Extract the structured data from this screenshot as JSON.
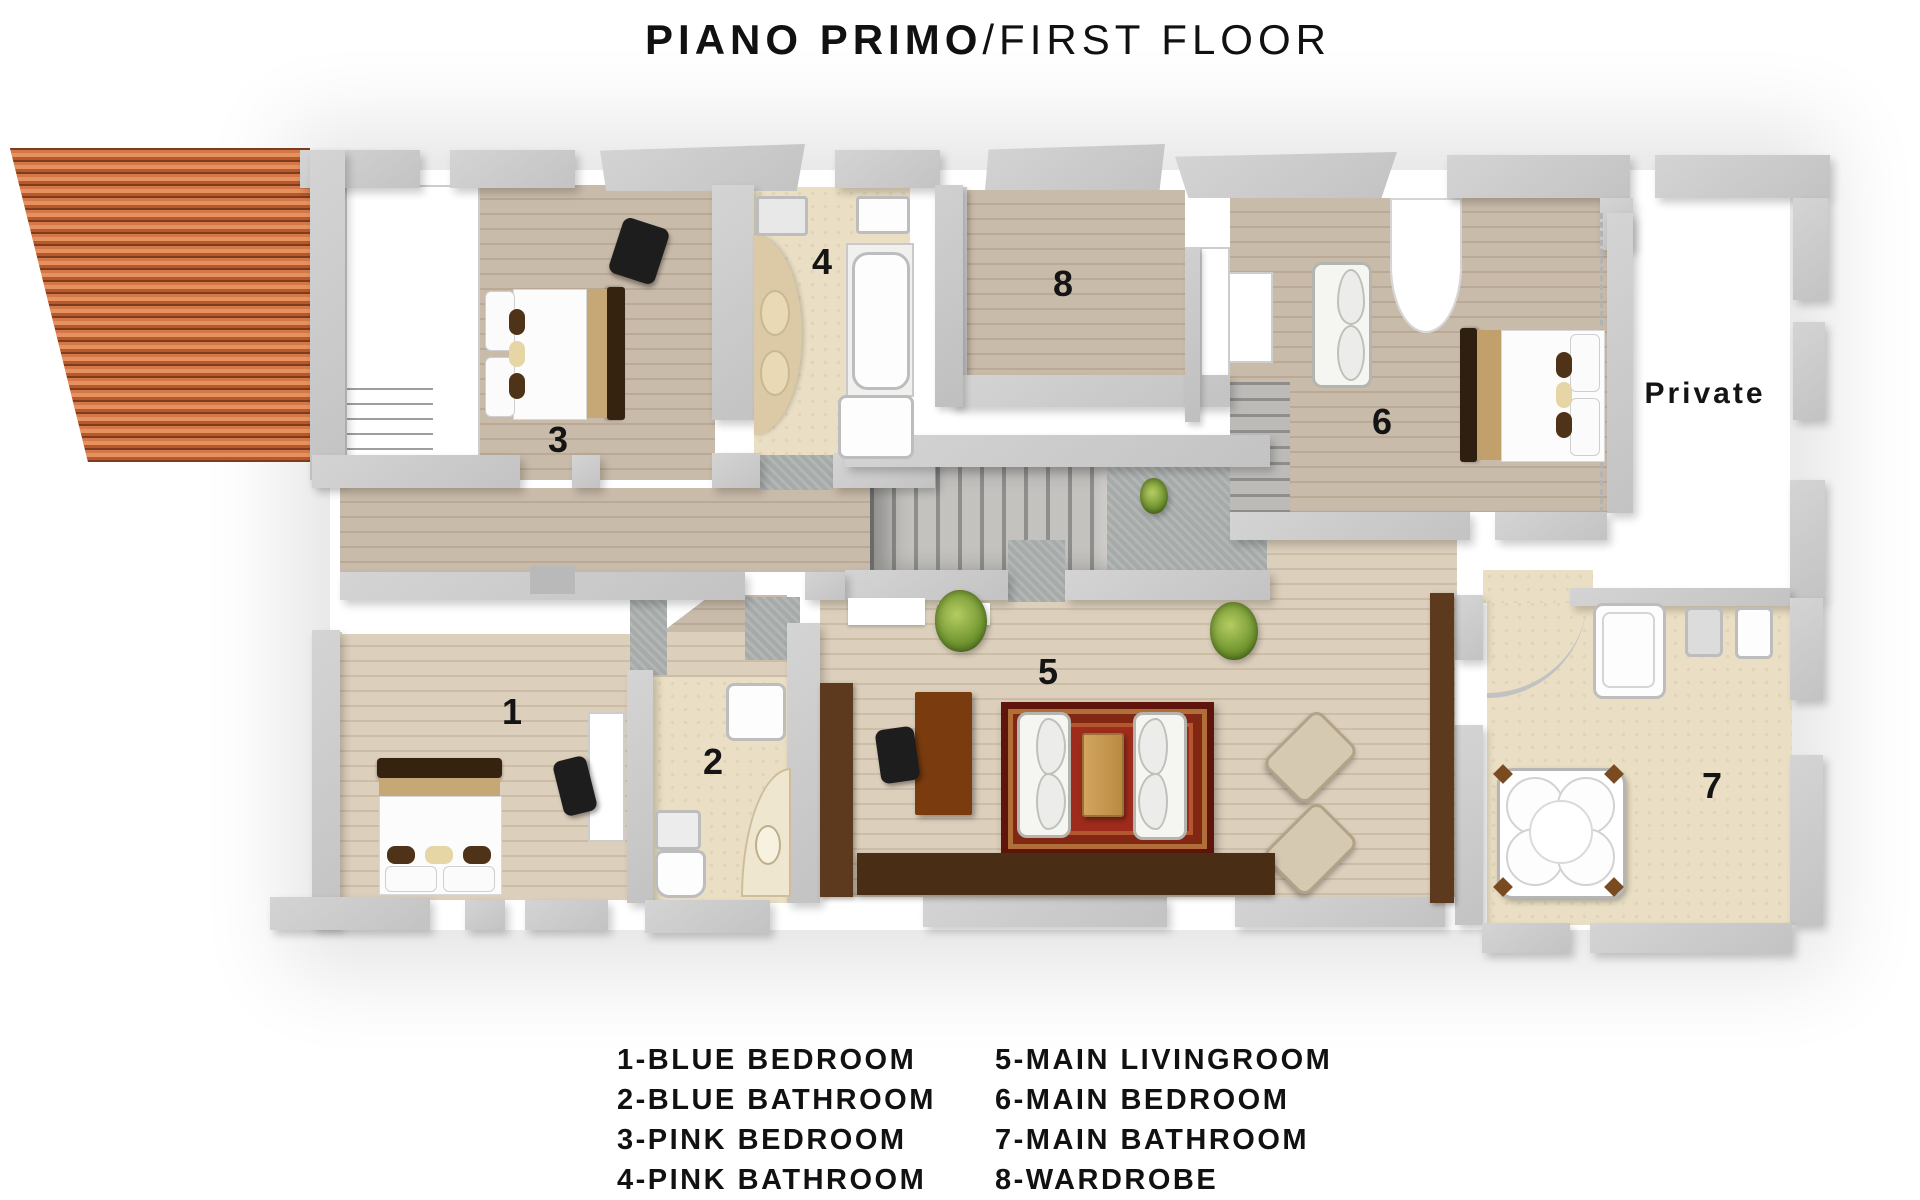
{
  "title": {
    "bold": "PIANO PRIMO",
    "regular": "/FIRST FLOOR"
  },
  "plan": {
    "private_label": "Private",
    "room_labels": [
      {
        "num": "1",
        "room": "blue-bedroom"
      },
      {
        "num": "2",
        "room": "blue-bathroom"
      },
      {
        "num": "3",
        "room": "pink-bedroom"
      },
      {
        "num": "4",
        "room": "pink-bathroom"
      },
      {
        "num": "5",
        "room": "main-livingroom"
      },
      {
        "num": "6",
        "room": "main-bedroom"
      },
      {
        "num": "7",
        "room": "main-bathroom"
      },
      {
        "num": "8",
        "room": "wardrobe"
      }
    ]
  },
  "legend": {
    "items": [
      {
        "text": "1-BLUE BEDROOM"
      },
      {
        "text": "2-BLUE BATHROOM"
      },
      {
        "text": "3-PINK BEDROOM"
      },
      {
        "text": "4-PINK BATHROOM"
      },
      {
        "text": "5-MAIN LIVINGROOM"
      },
      {
        "text": "6-MAIN BEDROOM"
      },
      {
        "text": "7-MAIN BATHROOM"
      },
      {
        "text": "8-WARDROBE"
      }
    ]
  },
  "colors": {
    "wall_gray": "#c9c9c9",
    "wood_gray_tan": "#c4b5a4",
    "wood_light_tan": "#d8cbb8",
    "bathroom_beige": "#eadfc4",
    "roof_tile_orange": "#c96a38",
    "rug_red": "#9e2b1c",
    "desk_brown": "#7a3c0e",
    "sideboard_brown": "#4a2d15",
    "headboard_brown": "#352413",
    "blanket_tan": "#c6a877",
    "plant_green": "#6f942e",
    "stair_gray": "#a9a9a9",
    "text_black": "#141414"
  }
}
